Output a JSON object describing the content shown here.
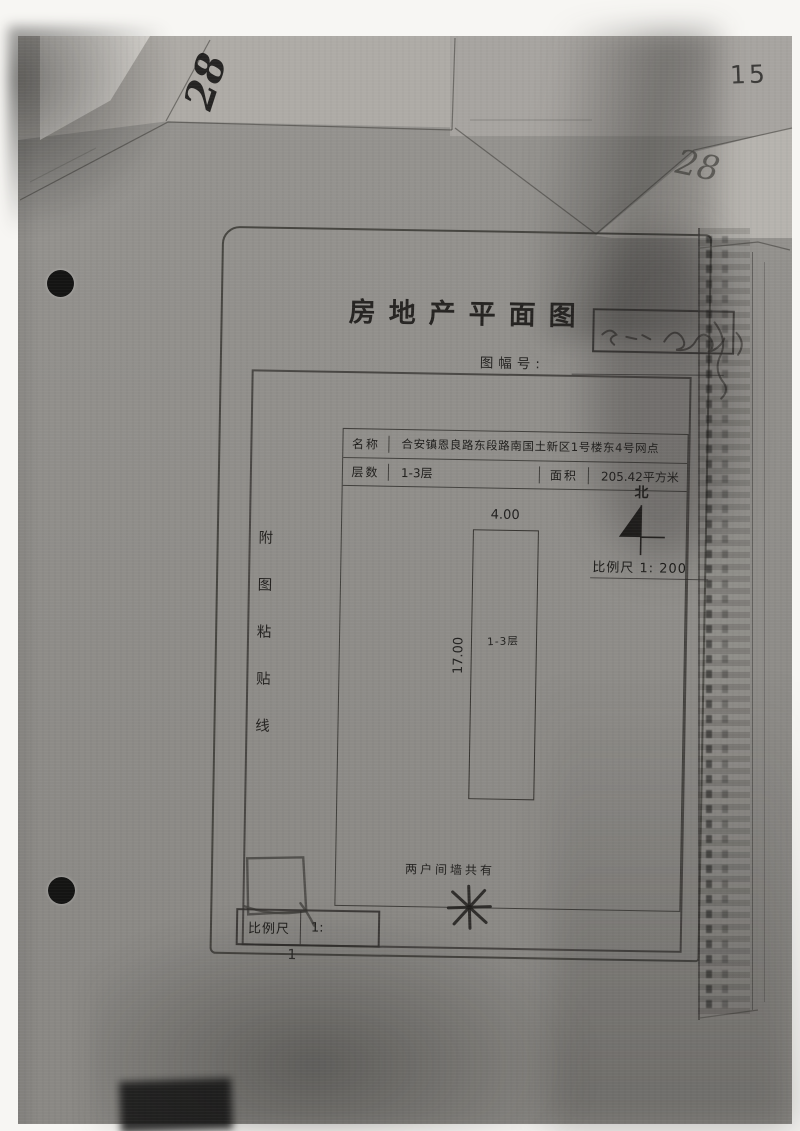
{
  "scan": {
    "page_number": "15",
    "handwritten_top_left": "28",
    "handwritten_top_right": "28"
  },
  "form": {
    "title": "房地产平面图",
    "sheet_number_label": "图幅号:",
    "paste_line": {
      "chars": [
        "附",
        "图",
        "粘",
        "贴",
        "线"
      ]
    },
    "table": {
      "name_label": "名称",
      "name_value": "合安镇恩良路东段路南国土新区1号楼东4号网点",
      "floors_label": "层数",
      "floors_value": "1-3层",
      "area_label": "面积",
      "area_value": "205.42平方米"
    },
    "compass": {
      "north_label": "北",
      "scale_text": "比例尺 1: 200"
    },
    "plan": {
      "top_dim": "4.00",
      "side_dim": "17.00",
      "unit_label": "1-3层",
      "note": "两户间墙共有"
    },
    "footer": {
      "scale_label": "比例尺",
      "scale_value": "1:",
      "page_mark": "1"
    }
  },
  "colors": {
    "scan_gray": "#918f8b",
    "line_dark": "#3a3834",
    "ink": "#1f1e1c"
  }
}
